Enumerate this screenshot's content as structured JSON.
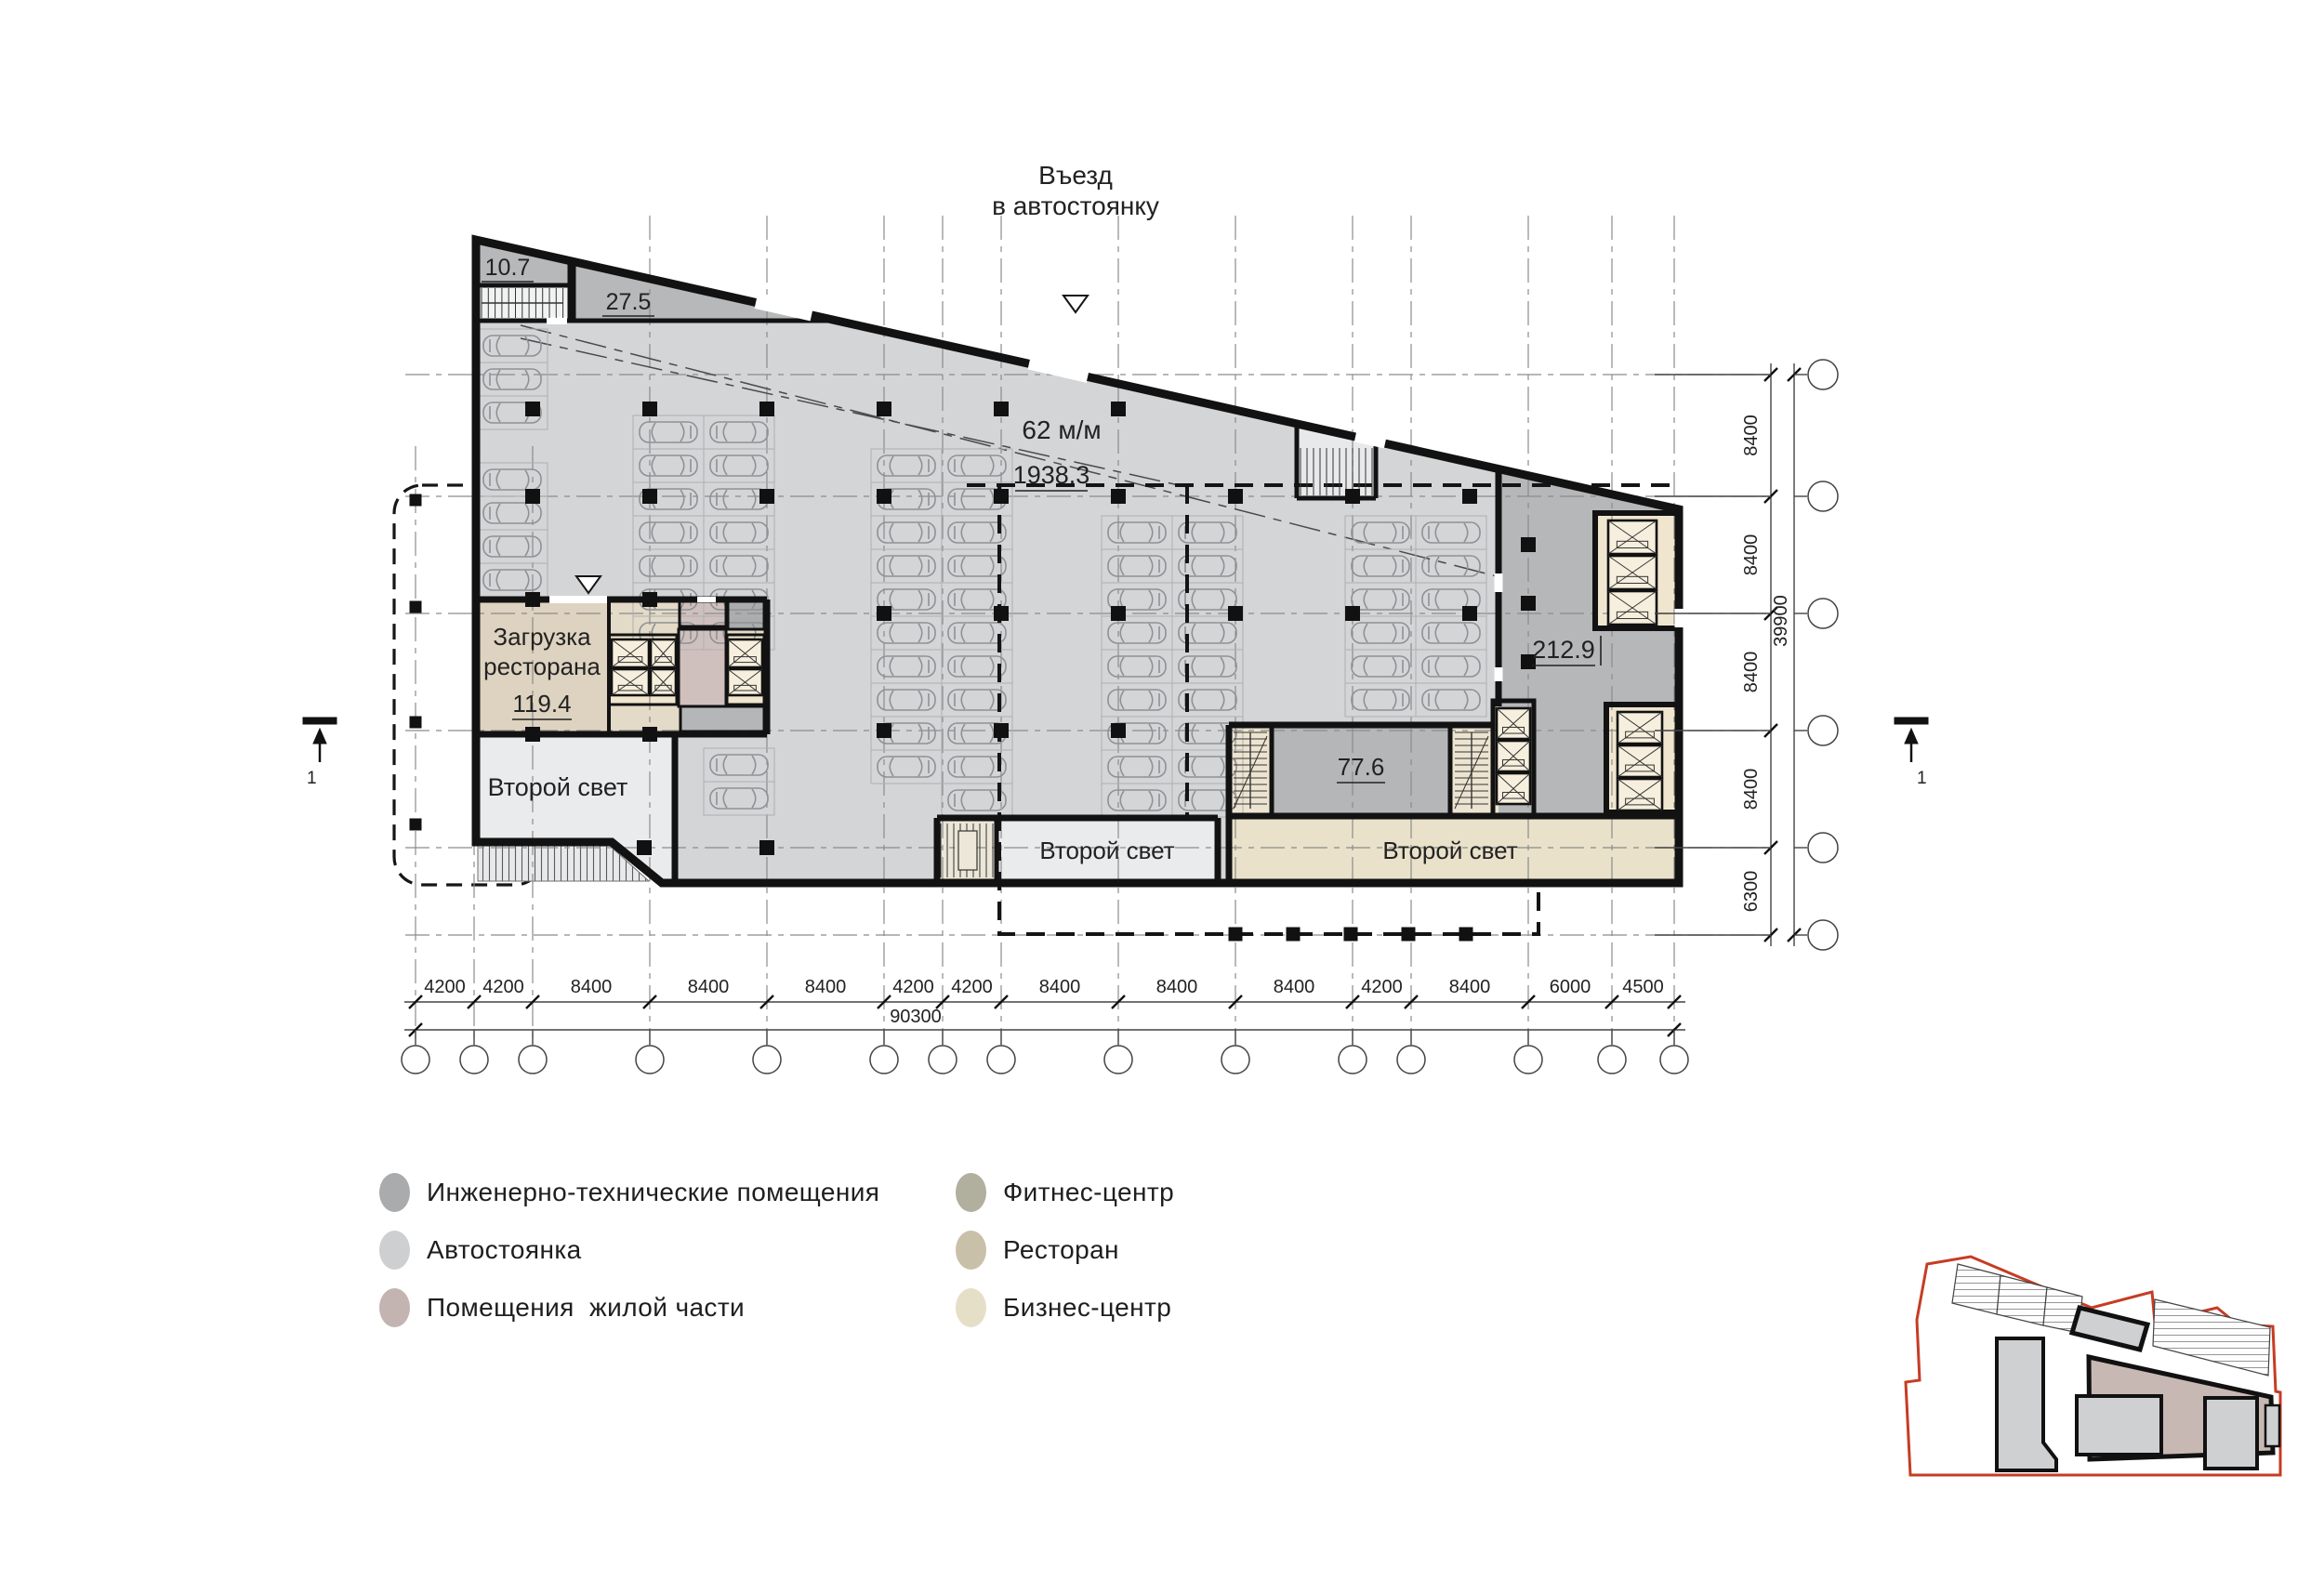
{
  "document": {
    "type": "architectural-floor-plan",
    "level": "parking"
  },
  "entrance": {
    "line1": "Въезд",
    "line2": "в автостоянку"
  },
  "labels": {
    "room_10_7": "10.7",
    "room_27_5": "27.5",
    "parking_capacity": "62 м/м",
    "parking_area": "1938.3",
    "loading_line1": "Загрузка",
    "loading_line2": "ресторана",
    "loading_area": "119.4",
    "second_light_left": "Второй свет",
    "second_light_mid": "Второй свет",
    "second_light_right": "Второй свет",
    "room_77_6": "77.6",
    "room_212_9": "212.9"
  },
  "dimensions": {
    "bottom": {
      "segments": [
        "4200",
        "4200",
        "8400",
        "8400",
        "8400",
        "4200",
        "4200",
        "8400",
        "8400",
        "8400",
        "4200",
        "8400",
        "6000",
        "4500"
      ],
      "total": "90300"
    },
    "right": {
      "segments": [
        "8400",
        "8400",
        "8400",
        "8400",
        "6300"
      ],
      "total": "39900"
    }
  },
  "section_marker": "1",
  "legend": {
    "items": [
      {
        "label": "Инженерно-технические помещения",
        "color": "#a9abad"
      },
      {
        "label": "Автостоянка",
        "color": "#cdcfd1"
      },
      {
        "label": "Помещения  жилой части",
        "color": "#c3b4b2"
      },
      {
        "label": "Фитнес-центр",
        "color": "#b1af9d"
      },
      {
        "label": "Ресторан",
        "color": "#c9c0a9"
      },
      {
        "label": "Бизнес-центр",
        "color": "#e6dfc7"
      }
    ]
  },
  "colors": {
    "parking_fill": "#d3d5d7",
    "engineering_fill": "#b6b8ba",
    "restaurant_fill": "#ddd3c0",
    "business_fill": "#e9e1c9",
    "residential_fill": "#cfc0be",
    "second_light_fill": "#eaebec",
    "lift_core_fill": "#f0e6cf",
    "wall": "#121212",
    "site_boundary": "#c63c24"
  }
}
